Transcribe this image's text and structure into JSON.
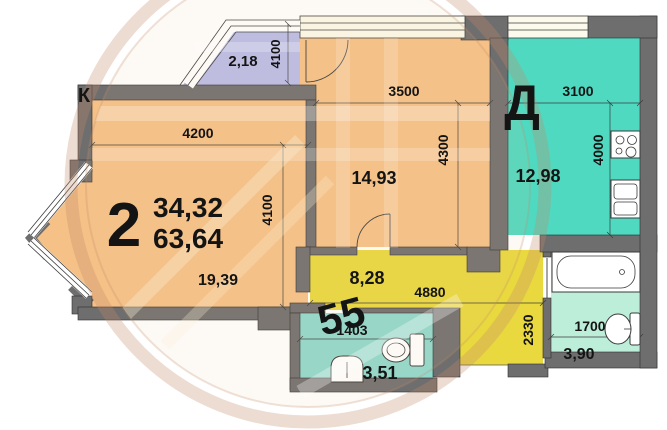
{
  "plan": {
    "apartment": {
      "number": "2",
      "living_area": "34,32",
      "total_area": "63,64"
    },
    "rooms": {
      "living": {
        "area": "19,39",
        "dim_w": "4200",
        "dim_h": "4100"
      },
      "balcony": {
        "area": "2,18",
        "dim_h": "4100"
      },
      "bedroom": {
        "area": "14,93",
        "dim_w": "3500",
        "dim_h": "4300"
      },
      "kitchen": {
        "area": "12,98",
        "dim_w": "3100",
        "dim_h": "4000"
      },
      "hall": {
        "area": "8,28",
        "dim_w": "4880",
        "dim_h": "2330"
      },
      "bathroom": {
        "area": "3,51",
        "dim_w": "1403"
      },
      "wc": {
        "area": "3,90",
        "dim_w": "1700"
      }
    },
    "watermark": {
      "letter_k": "К",
      "letter_d": "Д",
      "number": "55"
    },
    "colors": {
      "wall": "#6f6e6e",
      "living": "#f5c187",
      "bedroom": "#f5c187",
      "kitchen": "#4fd9c1",
      "hall": "#e9d93f",
      "bathroom": "#8fdacd",
      "wc": "#bdeeda",
      "balcony": "#b9bde9",
      "window": "#fcfaec"
    }
  }
}
